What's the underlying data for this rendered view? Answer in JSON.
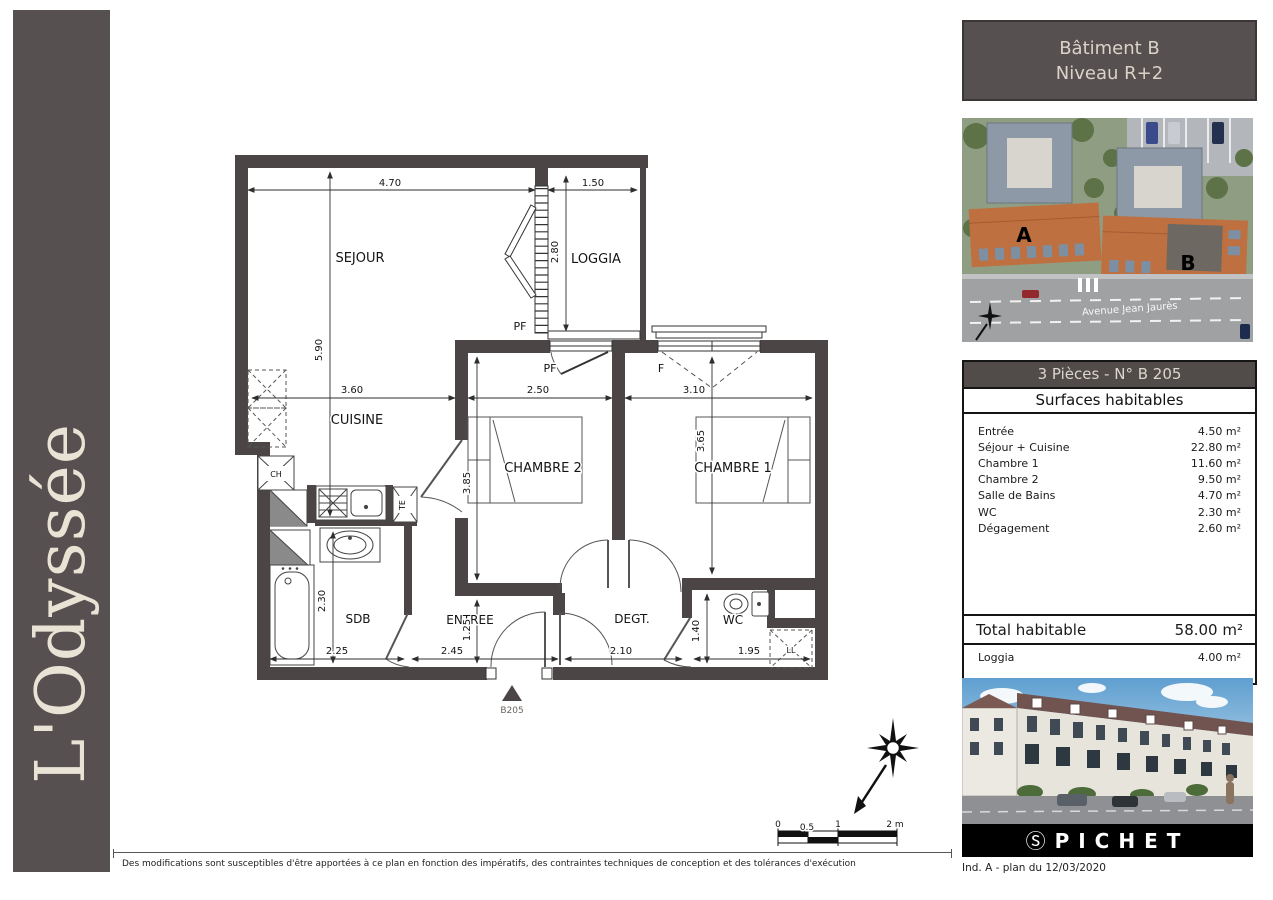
{
  "sidebar": {
    "title": "L'Odyssée"
  },
  "header": {
    "line1": "Bâtiment B",
    "line2": "Niveau R+2"
  },
  "aerial": {
    "label_a": "A",
    "label_b": "B",
    "street": "Avenue Jean Jaurès"
  },
  "surface_table": {
    "title": "3 Pièces - N° B 205",
    "subtitle": "Surfaces habitables",
    "rows": [
      {
        "label": "Entrée",
        "value": "4.50 m²"
      },
      {
        "label": "Séjour + Cuisine",
        "value": "22.80 m²"
      },
      {
        "label": "Chambre 1",
        "value": "11.60 m²"
      },
      {
        "label": "Chambre 2",
        "value": "9.50 m²"
      },
      {
        "label": "Salle de Bains",
        "value": "4.70 m²"
      },
      {
        "label": "WC",
        "value": "2.30 m²"
      },
      {
        "label": "Dégagement",
        "value": "2.60 m²"
      }
    ],
    "total": {
      "label": "Total habitable",
      "value": "58.00 m²"
    },
    "extra": {
      "label": "Loggia",
      "value": "4.00 m²"
    }
  },
  "brand": {
    "logo_icon": "Ⓢ",
    "logo_text": "PICHET",
    "revision": "Ind. A - plan du 12/03/2020"
  },
  "footer": {
    "disclaimer": "Des modifications sont susceptibles d'être apportées à ce plan en fonction des impératifs, des contraintes techniques de conception et des tolérances d'exécution"
  },
  "plan": {
    "unit_marker": "B205",
    "room_labels": [
      {
        "t": "SEJOUR",
        "x": 360,
        "y": 262
      },
      {
        "t": "LOGGIA",
        "x": 596,
        "y": 263
      },
      {
        "t": "CUISINE",
        "x": 357,
        "y": 424
      },
      {
        "t": "CHAMBRE 2",
        "x": 543,
        "y": 472
      },
      {
        "t": "CHAMBRE 1",
        "x": 733,
        "y": 472
      },
      {
        "t": "SDB",
        "x": 358,
        "y": 623,
        "s": 12
      },
      {
        "t": "ENTREE",
        "x": 470,
        "y": 624,
        "s": 12
      },
      {
        "t": "DEGT.",
        "x": 632,
        "y": 623,
        "s": 12
      },
      {
        "t": "WC",
        "x": 733,
        "y": 624,
        "s": 12
      }
    ],
    "dim_labels": [
      {
        "t": "4.70",
        "x": 390,
        "y": 186
      },
      {
        "t": "1.50",
        "x": 593,
        "y": 186
      },
      {
        "t": "5.90",
        "x": 322,
        "y": 350,
        "r": -90
      },
      {
        "t": "2.80",
        "x": 558,
        "y": 252,
        "r": -90
      },
      {
        "t": "3.60",
        "x": 352,
        "y": 393
      },
      {
        "t": "2.50",
        "x": 538,
        "y": 393
      },
      {
        "t": "3.10",
        "x": 694,
        "y": 393
      },
      {
        "t": "3.85",
        "x": 470,
        "y": 483,
        "r": -90
      },
      {
        "t": "3.65",
        "x": 704,
        "y": 441,
        "r": -90
      },
      {
        "t": "2.30",
        "x": 325,
        "y": 601,
        "r": -90
      },
      {
        "t": "1.25",
        "x": 470,
        "y": 630,
        "r": -90
      },
      {
        "t": "1.40",
        "x": 699,
        "y": 631,
        "r": -90
      },
      {
        "t": "2.25",
        "x": 337,
        "y": 654
      },
      {
        "t": "2.45",
        "x": 452,
        "y": 654
      },
      {
        "t": "2.10",
        "x": 621,
        "y": 654
      },
      {
        "t": "1.95",
        "x": 749,
        "y": 654
      }
    ],
    "fixture_labels": [
      {
        "t": "PF",
        "x": 520,
        "y": 330,
        "s": 11
      },
      {
        "t": "PF",
        "x": 550,
        "y": 372,
        "s": 11
      },
      {
        "t": "F",
        "x": 661,
        "y": 372,
        "s": 11
      },
      {
        "t": "CH",
        "x": 276,
        "y": 477,
        "s": 8
      },
      {
        "t": "TE",
        "x": 405,
        "y": 505,
        "s": 8,
        "r": -90
      },
      {
        "t": "LL",
        "x": 791,
        "y": 653,
        "s": 8
      },
      {
        "t": "B205",
        "x": 512,
        "y": 713,
        "s": 9,
        "c": "#6b6460"
      }
    ],
    "scale_labels": [
      {
        "t": "0",
        "x": 778,
        "y": 827
      },
      {
        "t": "0.5",
        "x": 807,
        "y": 830
      },
      {
        "t": "1",
        "x": 838,
        "y": 827
      },
      {
        "t": "2 m",
        "x": 895,
        "y": 827
      }
    ]
  }
}
